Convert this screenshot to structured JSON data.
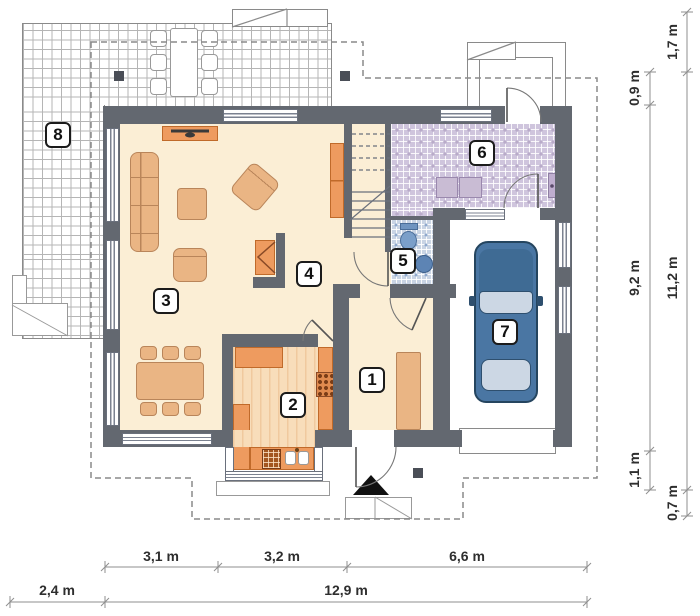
{
  "plan_title": "ground floor plan",
  "labels": {
    "l1": "1",
    "l2": "2",
    "l3": "3",
    "l4": "4",
    "l5": "5",
    "l6": "6",
    "l7": "7",
    "l8": "8"
  },
  "dims": {
    "w1": "3,1 m",
    "w2": "3,2 m",
    "w3": "6,6 m",
    "w4": "2,4 m",
    "w5": "12,9 m",
    "h1": "1,7 m",
    "h2": "0,9 m",
    "h3": "9,2 m",
    "h4": "11,2 m",
    "h5": "1,1 m",
    "h6": "0,7 m"
  },
  "colors": {
    "wall": "#636870",
    "floor": "#fbeed5",
    "hall_tile": "#cfc5dd",
    "wc_tile": "#c9d4e4",
    "furniture": "#eab584",
    "counter": "#ee9b5f",
    "car_body": "#4a76a3",
    "car_window": "#ccd7e4",
    "dimension_text": "#2e2e2e"
  }
}
